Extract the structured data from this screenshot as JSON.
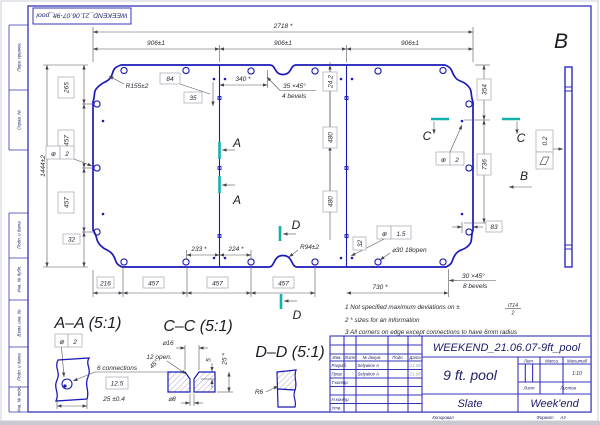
{
  "colors": {
    "line_blue": "#1a1ab8",
    "frame_blue": "#3434b8",
    "section_teal": "#12b2ac",
    "dim_grey": "#55555e"
  },
  "page": {
    "flip_label": "WEEKEND_21.06.07-9ft_pool",
    "copied_label": "Копировал",
    "format_label": "Формат",
    "format_value": "A3"
  },
  "sidebar": {
    "items": [
      {
        "label": "Перв. примен."
      },
      {
        "label": "Справ. №"
      },
      {
        "label": "Подп. и дата"
      },
      {
        "label": "Инв. № дубл."
      },
      {
        "label": "Взам. инв. №"
      },
      {
        "label": "Подп. и дата"
      },
      {
        "label": "Инв. № подл."
      }
    ]
  },
  "notes": {
    "line1_prefix": "1  Not specified maximum deviations on ±",
    "line1_frac_top": "IT14",
    "line1_frac_bot": "2",
    "line2": "2  * sizes for an information",
    "line3": "3  All corners on edge except connections to have 6mm radius"
  },
  "titleblock": {
    "doc_number": "WEEKEND_21.06.07-9ft_pool",
    "part_name": "9 ft. pool",
    "material": "Slate",
    "company": "Week'end",
    "scale_value": "1:10",
    "headers": {
      "lit": "Лит.",
      "mass": "Масса",
      "scale": "Масштаб",
      "sheet": "Лист",
      "sheets": "Листов"
    },
    "cols": {
      "izm": "Изм.",
      "list": "Лист",
      "doc": "№ докум.",
      "podp": "Подп.",
      "data": "Дата"
    },
    "rows": [
      {
        "role": "Разраб.",
        "name": "Selyakov A",
        "date": "21.06"
      },
      {
        "role": "Пров.",
        "name": "Selyakov A",
        "date": "21.06"
      },
      {
        "role": "Т.контр.",
        "name": "",
        "date": ""
      },
      {
        "role": "Н.контр.",
        "name": "",
        "date": ""
      },
      {
        "role": "Утв.",
        "name": "",
        "date": ""
      }
    ]
  },
  "views": {
    "aa_title": "A–A (5:1)",
    "cc_title": "C–C (5:1)",
    "dd_title": "D–D (5:1)",
    "connections_note": "6 connections"
  },
  "letters": {
    "a": "A",
    "b": "B",
    "c": "C",
    "d": "D"
  },
  "icons": {
    "position_tolerance": "⊕",
    "flatness": "parallelogram",
    "diameter": "⌀"
  },
  "dims": {
    "w_total": "2718 *",
    "w_seg": "906±1",
    "h_total": "1444±2",
    "v265": "265",
    "v457": "457",
    "v32": "32",
    "r155": "R155±2",
    "b84": "84",
    "b35": "35",
    "d340": "340 *",
    "bevel35": "35 ×45°",
    "bevel35_note": "4 bevels",
    "v242": "24.2",
    "v480": "480",
    "v354": "354",
    "v736": "736",
    "b83": "83",
    "flatness": "0.2",
    "pos2": "2",
    "pos15": "1.5",
    "holes30": "⌀30  18open",
    "d233": "233 *",
    "d224": "224 *",
    "r94": "R94±2",
    "b216": "216",
    "d730": "730 *",
    "bevel30": "30 ×45°",
    "bevel30_note": "8 bevels",
    "b125": "12.5",
    "d25": "25 ±0.4",
    "cc_d16": "⌀16",
    "cc_open": "12 open.",
    "cc_45": "45°",
    "cc_5": "5",
    "cc_25": "25 *",
    "cc_d8": "⌀8",
    "dd_r6": "R6"
  }
}
